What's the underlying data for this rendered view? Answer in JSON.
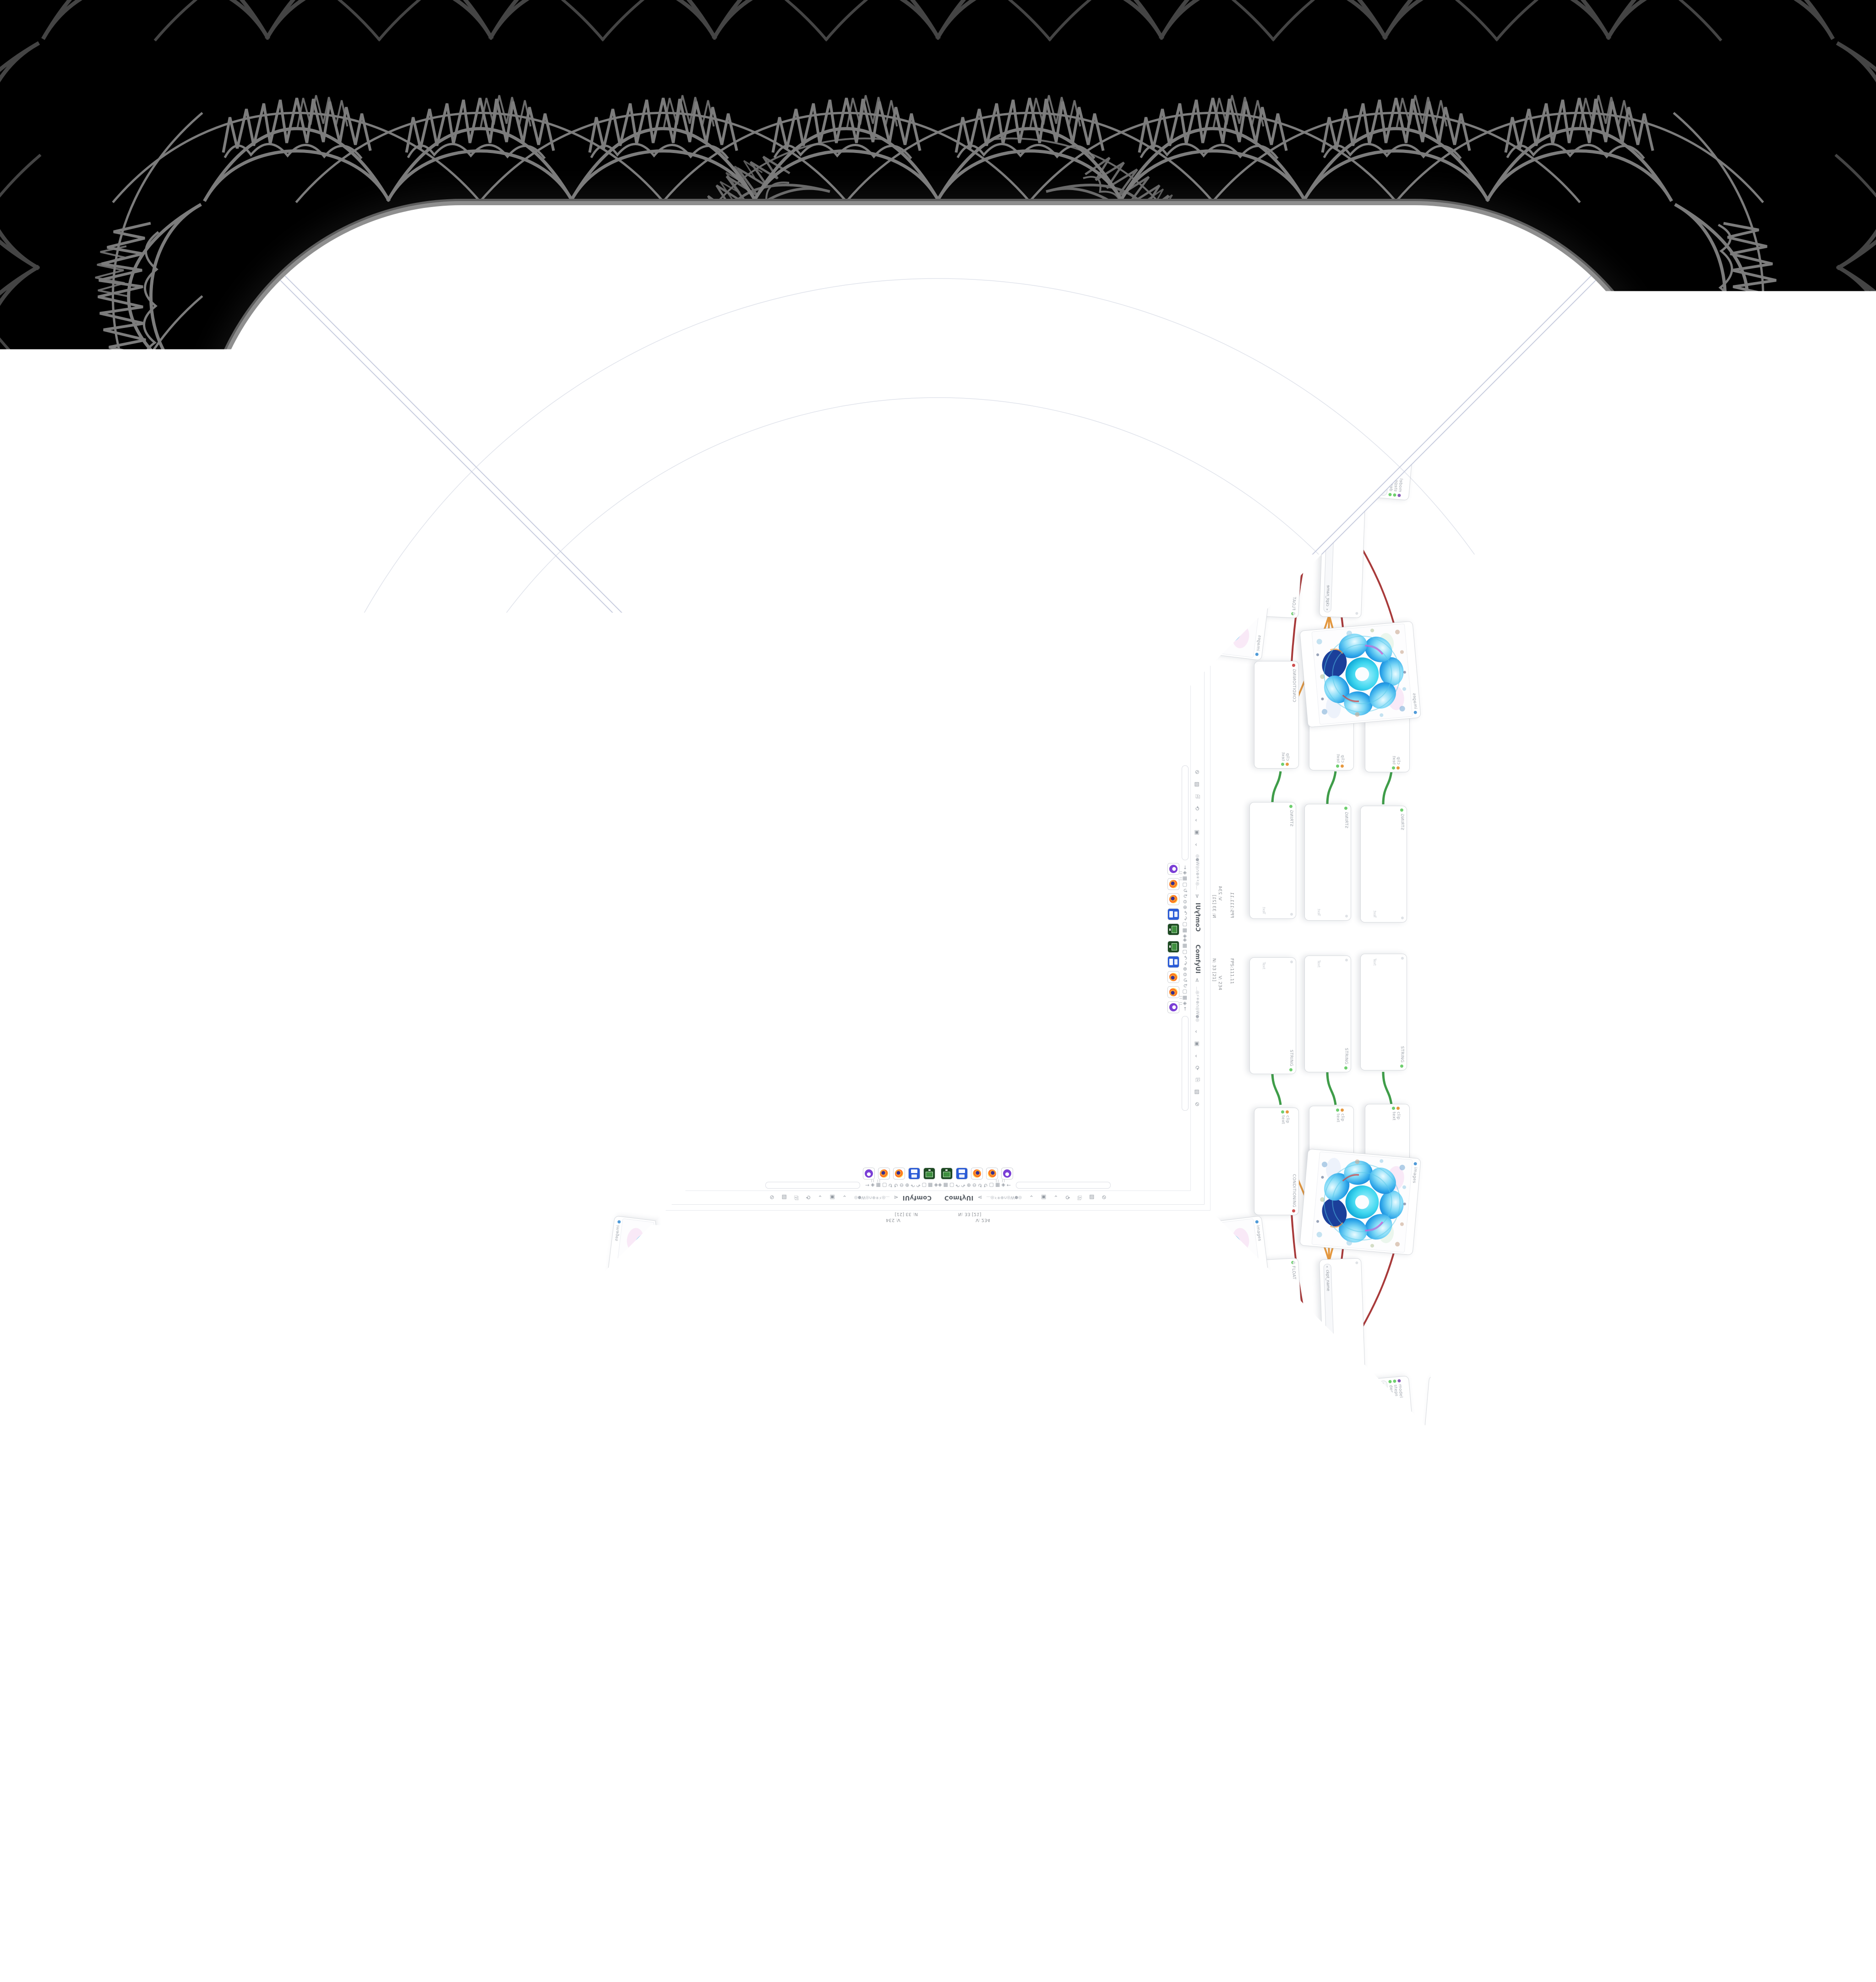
{
  "window": {
    "url_badge": "kadirnar-comfyui-demo.hf.space",
    "monitor_badge": "DLCS RDY SE PE 4939 5770"
  },
  "menubar": {
    "logo": "ComfyUI",
    "share_icon": "⋖",
    "workflow_name": "…◎⚡✳⊕∩◎W●◎",
    "caret_icon": "⌄",
    "save_icon": "▣",
    "save_caret_icon": "⌄",
    "refresh_icon": "⟳",
    "clipboard_icon": "⎘",
    "export_image_icon": "▧",
    "clear_icon": "⊘"
  },
  "canvas_toolbar": {
    "glyph_run": "◈▦▢↶↷⊕⊖↺↻▢▦◈←",
    "pause_marks": "II II"
  },
  "stats": {
    "fps": "FPS:111.11",
    "vram": "V: 234",
    "nodes": "N: 33 [21]",
    "images": "I: 0",
    "time": "T: 0.00s"
  },
  "dock": {
    "icons": [
      "robot-app-icon",
      "firefox-icon",
      "firefox-icon",
      "floppy-app-icon",
      "image-viewer-app-icon"
    ]
  },
  "queue": {
    "label": "Queue",
    "play_icon": "▶",
    "caret_icon": "⌃",
    "corner_icons": "⚙ ▥ ◍ ≡ « »",
    "close_icon": "×"
  },
  "nodes": {
    "checkpoint": {
      "widget_label": "ckpt_name",
      "widget_value": "RealVisXL_V4.0_Lightning.safetensors",
      "outputs": [
        "MODEL",
        "CLIP",
        "VAE"
      ]
    },
    "string": {
      "title": "STRING",
      "placeholder": "Text"
    },
    "conditioning": {
      "title": "CONDITIONING",
      "inputs": [
        "clip",
        "text"
      ]
    },
    "int_value": {
      "title": "INT",
      "widget_label": "Value",
      "widget_value": "8"
    },
    "int_steps": {
      "title": "INT",
      "widget_label": "int",
      "widget_value": "256"
    },
    "float_b": {
      "title": "FLOAT",
      "widget_label": "Value_B",
      "widget_value": "1.00"
    },
    "noise": {
      "title": "NOISE",
      "widgets": [
        "noise_seed",
        "control_after_generate",
        "noise_mode",
        "batch_seed_mode",
        "variation_seed",
        "variation_strength"
      ]
    },
    "scheduler": {
      "inputs": [
        "model",
        "steps",
        "denoise"
      ],
      "widget_label": "denoise",
      "widget_value": "1.00",
      "output": "SIGMAS"
    },
    "latent": {
      "widgets": [
        {
          "label": "width",
          "value": ""
        },
        {
          "label": "height",
          "value": ""
        },
        {
          "label": "batch_size",
          "value": "1"
        }
      ],
      "output": "LATENT"
    },
    "sampler_cfg": {
      "widgets": [
        {
          "label": "eta",
          "value": "0.00"
        },
        {
          "label": "s_noise",
          "value": "0.00"
        }
      ]
    },
    "sigmas_list": {
      "output": "SIGMAS",
      "values": [
        "0.00",
        "0.00",
        "0.00",
        "0.00",
        "0.00",
        "0.00",
        "0.00",
        "0.00"
      ]
    },
    "sampler_adv": {
      "inputs": [
        "noise",
        "guider",
        "sampler",
        "sigmas",
        "latent_image"
      ],
      "outputs": [
        "output",
        "denoised_output"
      ]
    },
    "vae_decode": {
      "inputs": [
        "samples",
        "vae"
      ],
      "output": "IMAGE"
    },
    "preview": {
      "input": "images"
    }
  }
}
